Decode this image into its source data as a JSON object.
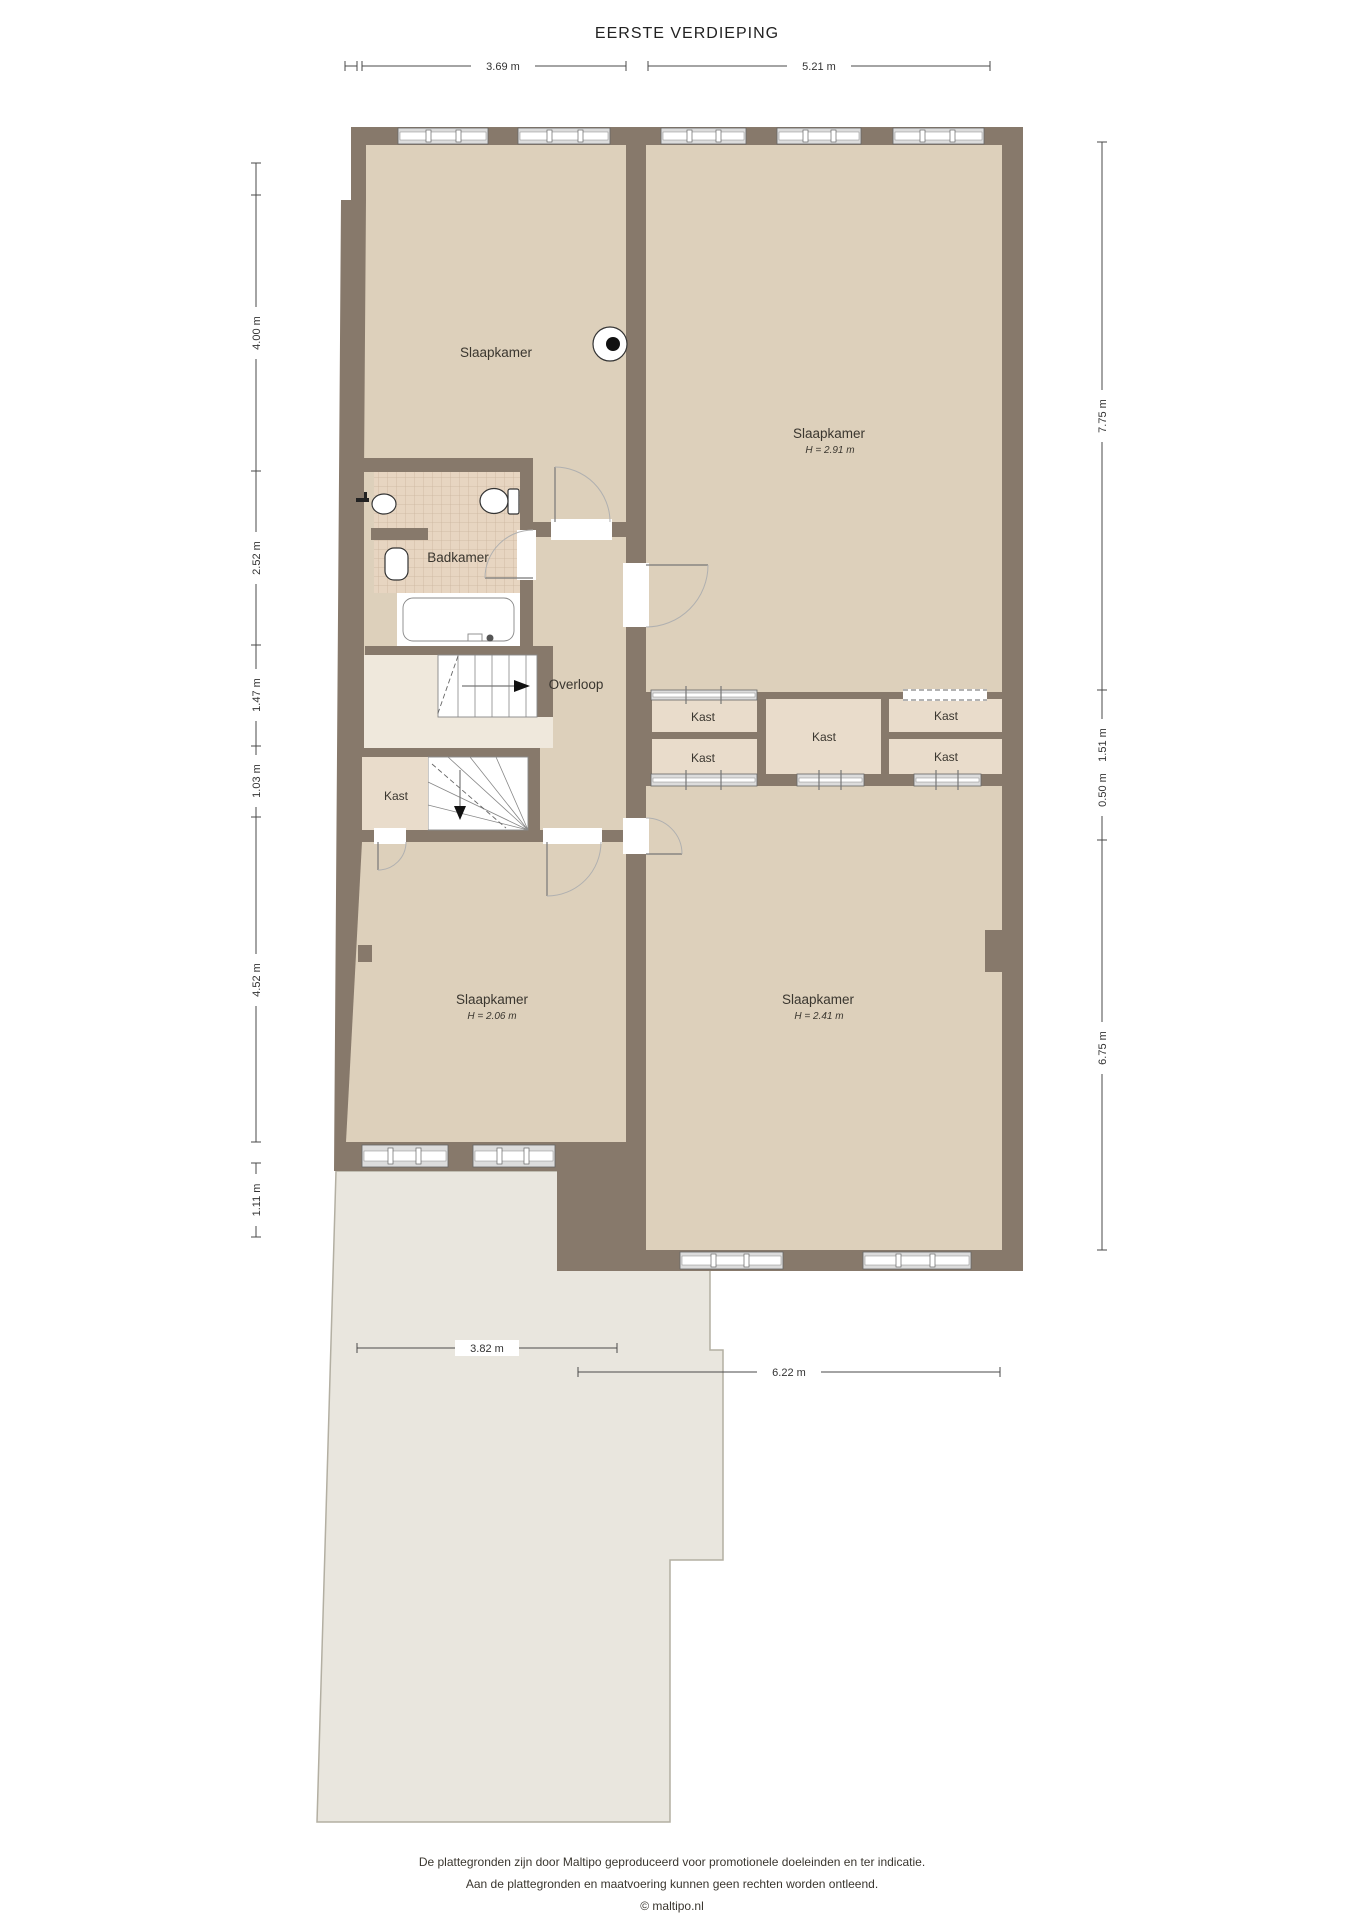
{
  "title": "EERSTE VERDIEPING",
  "colors": {
    "wall": "#87796b",
    "floor": "#ddd0bb",
    "closet_floor": "#e9dccb",
    "tile": "#e7d5c1",
    "roof": "#e9e6de",
    "white": "#ffffff"
  },
  "rooms": {
    "slaapkamer_tl": {
      "label": "Slaapkamer"
    },
    "slaapkamer_tr": {
      "label": "Slaapkamer",
      "height": "H = 2.91 m"
    },
    "badkamer": {
      "label": "Badkamer"
    },
    "overloop": {
      "label": "Overloop"
    },
    "kast_small": {
      "label": "Kast"
    },
    "kast_left_top": {
      "label": "Kast"
    },
    "kast_left_bottom": {
      "label": "Kast"
    },
    "kast_center": {
      "label": "Kast"
    },
    "kast_right_top": {
      "label": "Kast"
    },
    "kast_right_bottom": {
      "label": "Kast"
    },
    "slaapkamer_bl": {
      "label": "Slaapkamer",
      "height": "H = 2.06 m"
    },
    "slaapkamer_br": {
      "label": "Slaapkamer",
      "height": "H = 2.41 m"
    }
  },
  "dimensions": {
    "top": [
      "3.69 m",
      "5.21 m"
    ],
    "left": [
      "4.00 m",
      "2.52 m",
      "1.47 m",
      "1.03 m",
      "4.52 m",
      "1.11 m"
    ],
    "right": [
      "7.75 m",
      "1.51 m",
      "0.50 m",
      "6.75 m"
    ],
    "bottom": [
      "3.82 m",
      "6.22 m"
    ]
  },
  "footer": {
    "line1": "De plattegronden zijn door Maltipo geproduceerd voor promotionele doeleinden en ter indicatie.",
    "line2": "Aan de plattegronden en maatvoering kunnen geen rechten worden ontleend.",
    "line3": "© maltipo.nl"
  }
}
